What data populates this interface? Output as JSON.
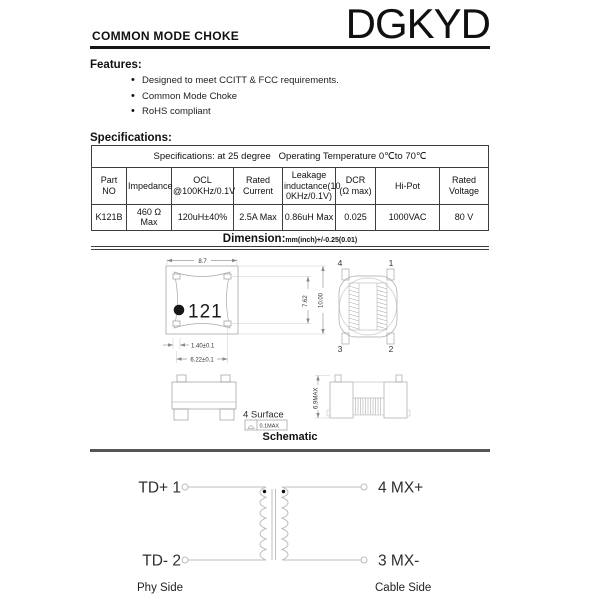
{
  "header": {
    "title": "COMMON MODE CHOKE",
    "brand": "DGKYD"
  },
  "features": {
    "heading": "Features:",
    "items": [
      "Designed to meet CCITT & FCC requirements.",
      "Common Mode Choke",
      "RoHS compliant"
    ]
  },
  "specifications": {
    "heading": "Specifications:",
    "table": {
      "condition_row": "Specifications: at 25 degree   Operating Temperature 0℃to 70℃",
      "columns": [
        "Part NO",
        "Impedance",
        "OCL\n@100KHz/0.1V",
        "Rated\nCurrent",
        "Leakage\ninductance(10\n0KHz/0.1V)",
        "DCR\n(Ω max)",
        "Hi-Pot",
        "Rated\nVoltage"
      ],
      "rows": [
        [
          "K121B",
          "460 Ω Max",
          "120uH±40%",
          "2.5A Max",
          "0.86uH Max",
          "0.025",
          "1000VAC",
          "80 V"
        ]
      ]
    }
  },
  "dimension": {
    "heading": "Dimension:",
    "tolerance": "mm(inch)+/-0.25(0.01)",
    "top_view": {
      "marking": "121",
      "dim_width": "8.7",
      "dim_pad_span": "7.62",
      "dim_height": "10.00",
      "dim_pad_width": "1.40±0.1",
      "dim_pad_pitch": "6.22±0.1"
    },
    "bottom_view": {
      "pin1": "1",
      "pin2": "2",
      "pin3": "3",
      "pin4": "4"
    },
    "side_view": {
      "note": "4 Surface",
      "coplanarity": "0.1MAX"
    },
    "side_view_2": {
      "dim_height": "6.9MAX"
    }
  },
  "schematic": {
    "heading": "Schematic",
    "pin_top_left": "TD+ 1",
    "pin_bottom_left": "TD- 2",
    "pin_top_right": "4 MX+",
    "pin_bottom_right": "3 MX-",
    "side_left": "Phy Side",
    "side_right": "Cable Side"
  }
}
